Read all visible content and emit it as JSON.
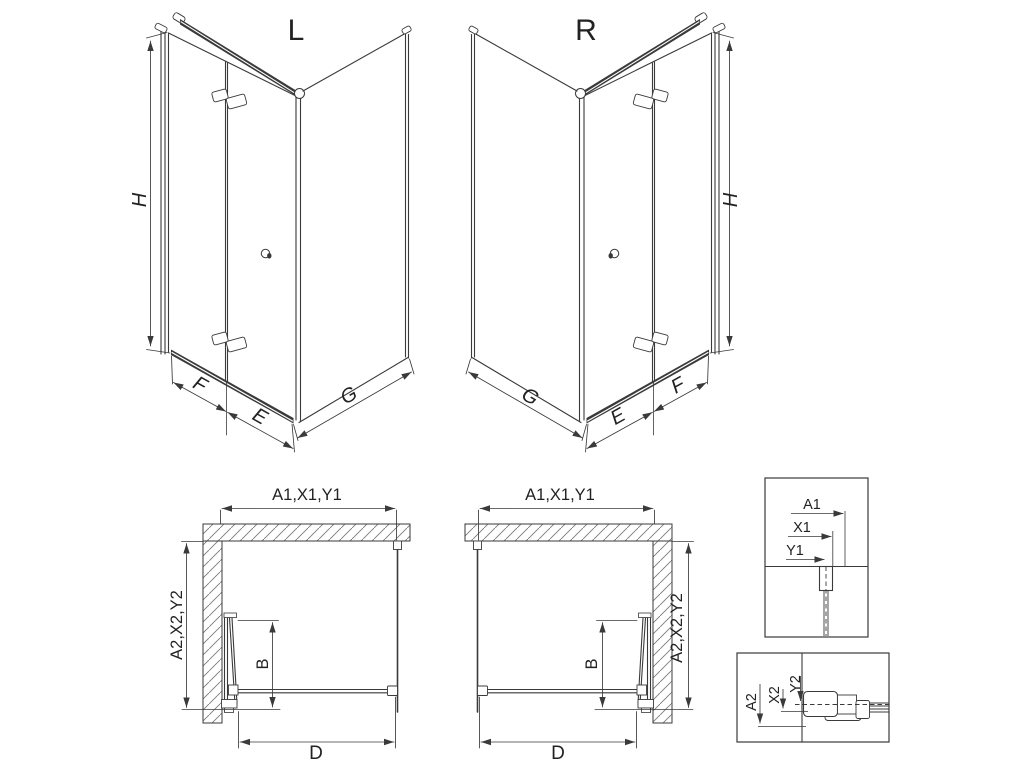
{
  "drawing": {
    "type": "shower-enclosure-technical-drawing",
    "colors": {
      "line": "#3a3a3a",
      "background": "#ffffff",
      "text": "#222222"
    },
    "iso_left": {
      "title": "L",
      "dim_height": "H",
      "dim_front_fixed": "F",
      "dim_front_door": "E",
      "dim_side": "G"
    },
    "iso_right": {
      "title": "R",
      "dim_height": "H",
      "dim_front_fixed": "F",
      "dim_front_door": "E",
      "dim_side": "G"
    },
    "plan_left": {
      "dim_top": "A1,X1,Y1",
      "dim_side": "A2,X2,Y2",
      "dim_door_depth": "B",
      "dim_clear_width": "D"
    },
    "plan_right": {
      "dim_top": "A1,X1,Y1",
      "dim_side": "A2,X2,Y2",
      "dim_door_depth": "B",
      "dim_clear_width": "D"
    },
    "detail_top": {
      "dim_a": "A1",
      "dim_x": "X1",
      "dim_y": "Y1"
    },
    "detail_bottom": {
      "dim_a": "A2",
      "dim_x": "X2",
      "dim_y": "Y2"
    }
  }
}
